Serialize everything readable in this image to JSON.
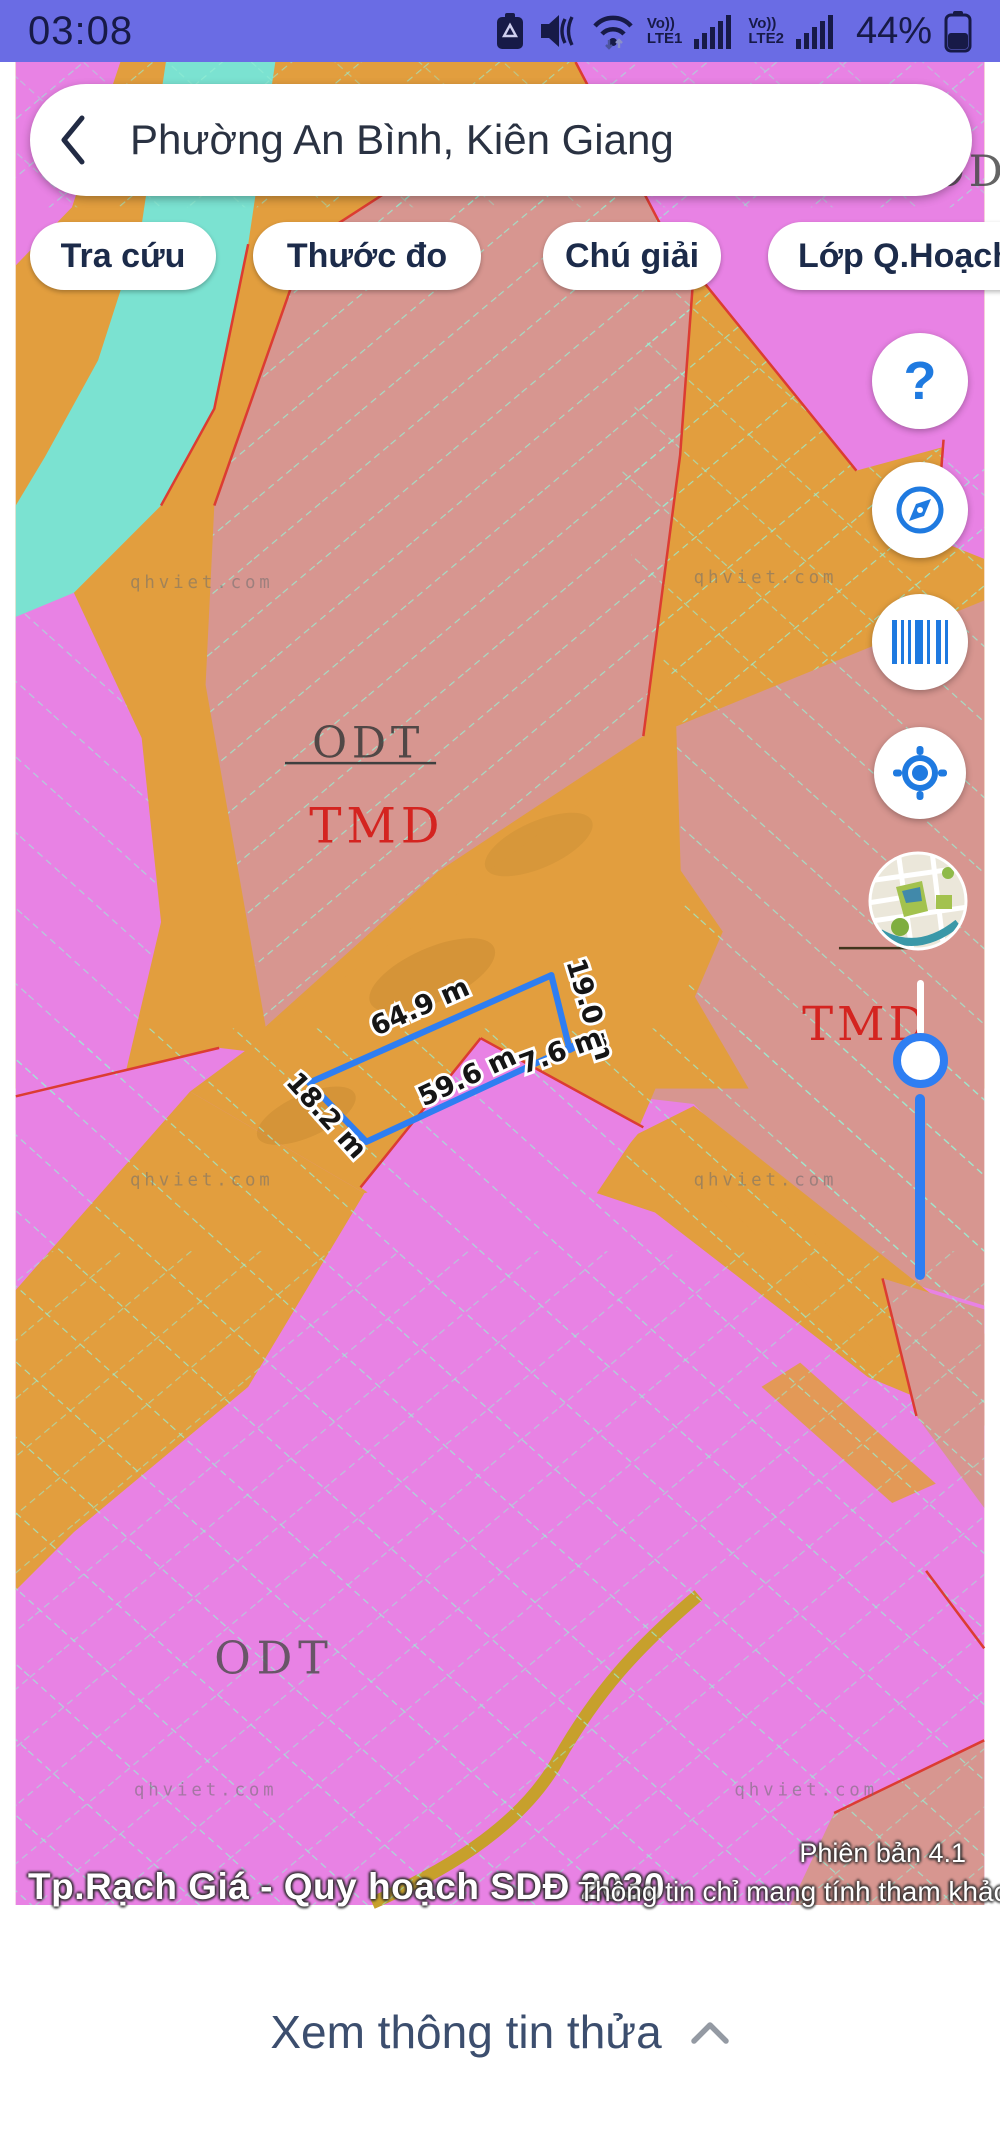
{
  "status_bar": {
    "time": "03:08",
    "net1_top": "Vo))",
    "net1_bottom": "LTE1",
    "net2_top": "Vo))",
    "net2_bottom": "LTE2",
    "battery_percent": "44%"
  },
  "search": {
    "query": "Phường An Bình, Kiên Giang"
  },
  "chips": {
    "items": [
      {
        "label": "Tra cứu"
      },
      {
        "label": "Thước đo"
      },
      {
        "label": "Chú giải"
      },
      {
        "label": "Lớp Q.Hoạch"
      }
    ]
  },
  "fab_icons": [
    "help-icon",
    "compass-icon",
    "barcode-icon",
    "my-location-icon",
    "minimap-icon"
  ],
  "map": {
    "watermark": "qhviet.com",
    "zone_labels": {
      "odt_top_right": "ODT",
      "odt_center": "ODT",
      "tmd_center": "TMD",
      "tmd_right": "TMD",
      "odt_bottom": "ODT"
    },
    "measurements": {
      "top": "64.9 m",
      "right": "19.0 m",
      "spur": "7.6 m",
      "bottom": "59.6 m",
      "left": "18.2 m"
    },
    "colors": {
      "zone_residential_magenta": "#e882e4",
      "zone_commercial_salmon": "#d79690",
      "zone_road_orange": "#e29e3e",
      "zone_water_teal": "#7be2d1",
      "parcel_line_aqua": "#96f0d2",
      "boundary_red": "#dc3c32",
      "measure_blue": "#2e7ef2",
      "statusbar_purple": "#6a6ce4",
      "accent_blue": "#1f7ae0"
    }
  },
  "footer": {
    "version": "Phiên bản 4.1",
    "title": "Tp.Rạch Giá - Quy hoạch SDĐ 2030",
    "disclaimer": "Thông tin chỉ mang tính tham khảo"
  },
  "bottom_sheet": {
    "label": "Xem thông tin thửa"
  }
}
